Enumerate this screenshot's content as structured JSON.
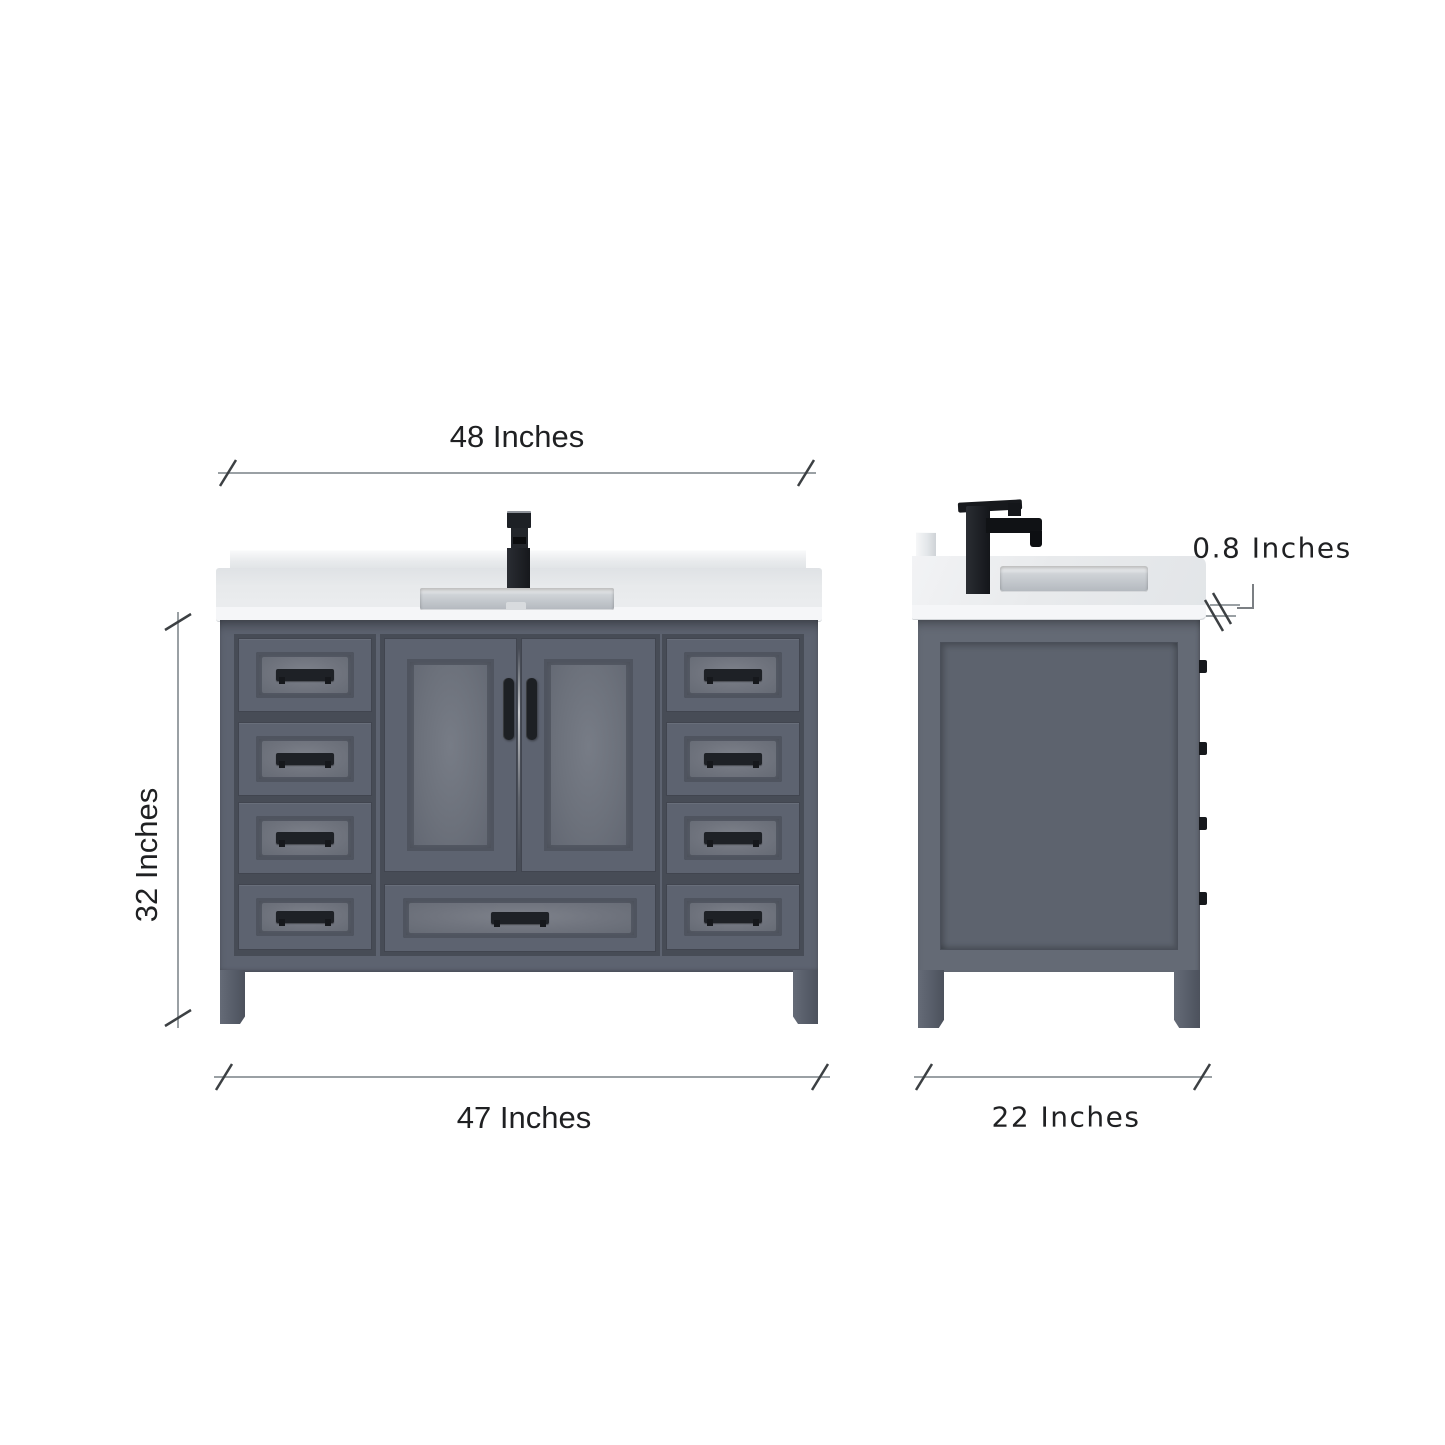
{
  "diagram": {
    "title": "bathroom-vanity-dimension-diagram",
    "views": {
      "front": {
        "top_width_label": "48 Inches",
        "height_label": "32 Inches",
        "bottom_width_label": "47 Inches"
      },
      "side": {
        "depth_label": "22 Inches",
        "countertop_thickness_label": "0.8 Inches"
      }
    },
    "colors": {
      "cabinet": "#5d6370",
      "cabinet_shadow": "#474c56",
      "panel_highlight": "#7e828b",
      "handle": "#1e2126",
      "countertop": "#eceef0",
      "countertop_edge": "#f5f6f8",
      "sink": "#b3b8be",
      "dimension_line": "#9aa0a4",
      "tick": "#3c4043",
      "text": "#1f2022",
      "background": "#ffffff"
    }
  }
}
